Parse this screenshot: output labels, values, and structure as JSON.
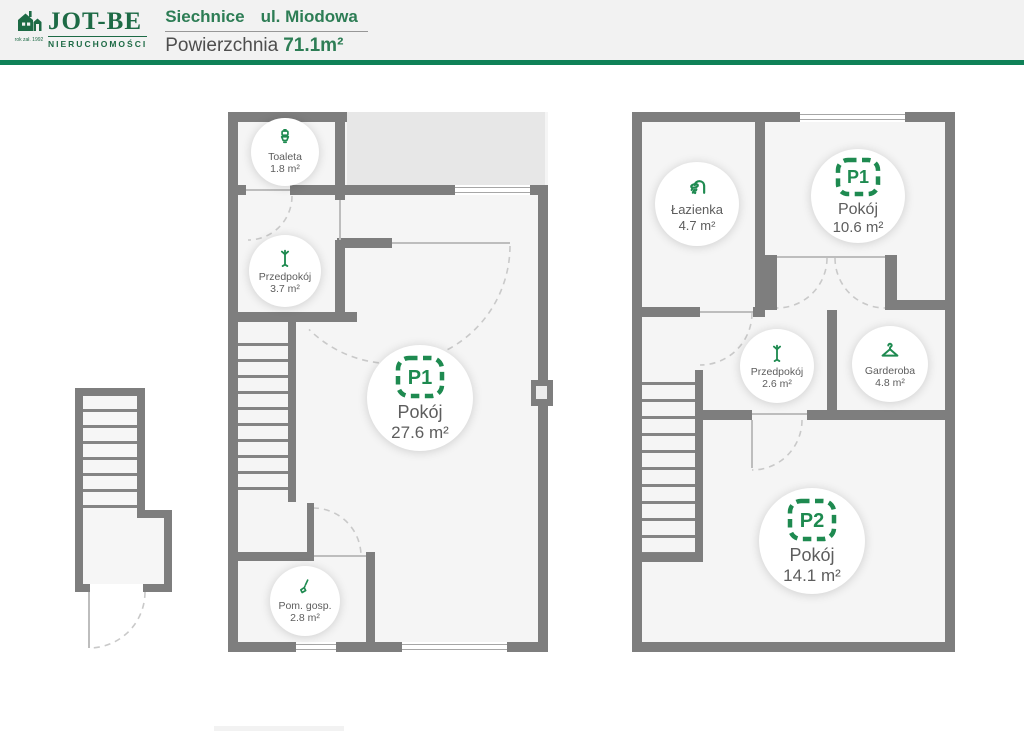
{
  "header": {
    "logo": {
      "brand": "JOT-BE",
      "tagline": "NIERUCHOMOŚCI",
      "established": "rok zał. 1992",
      "icon": "house-logo-icon",
      "brand_color": "#1d6a45"
    },
    "location": {
      "city": "Siechnice",
      "street": "ul. Miodowa"
    },
    "area": {
      "label": "Powierzchnia",
      "value": "71.1m²"
    },
    "rule_color": "#0f8157"
  },
  "floor1": {
    "name": "floor-plan-level-1",
    "rooms": {
      "toaleta": {
        "icon": "toilet-icon",
        "name": "Toaleta",
        "area": "1.8 m²"
      },
      "przedpokoj": {
        "icon": "coat-rack-icon",
        "name": "Przedpokój",
        "area": "3.7 m²"
      },
      "pokoj": {
        "badge": "P1",
        "name": "Pokój",
        "area": "27.6 m²"
      },
      "pomgosp": {
        "icon": "broom-icon",
        "name": "Pom. gosp.",
        "area": "2.8 m²"
      }
    }
  },
  "floor2": {
    "name": "floor-plan-level-2",
    "rooms": {
      "lazienka": {
        "icon": "shower-icon",
        "name": "Łazienka",
        "area": "4.7 m²"
      },
      "pokoj1": {
        "badge": "P1",
        "name": "Pokój",
        "area": "10.6 m²"
      },
      "przedpokoj": {
        "icon": "coat-rack-icon",
        "name": "Przedpokój",
        "area": "2.6 m²"
      },
      "garderoba": {
        "icon": "hanger-icon",
        "name": "Garderoba",
        "area": "4.8 m²"
      },
      "pokoj2": {
        "badge": "P2",
        "name": "Pokój",
        "area": "14.1 m²"
      }
    }
  },
  "colors": {
    "brand_green": "#1d6a45",
    "accent_green": "#0f8157",
    "icon_green": "#1e8a50",
    "wall_gray": "#7e7e7e",
    "room_fill": "#f5f5f5",
    "terrace_fill": "#e7e7e7"
  }
}
